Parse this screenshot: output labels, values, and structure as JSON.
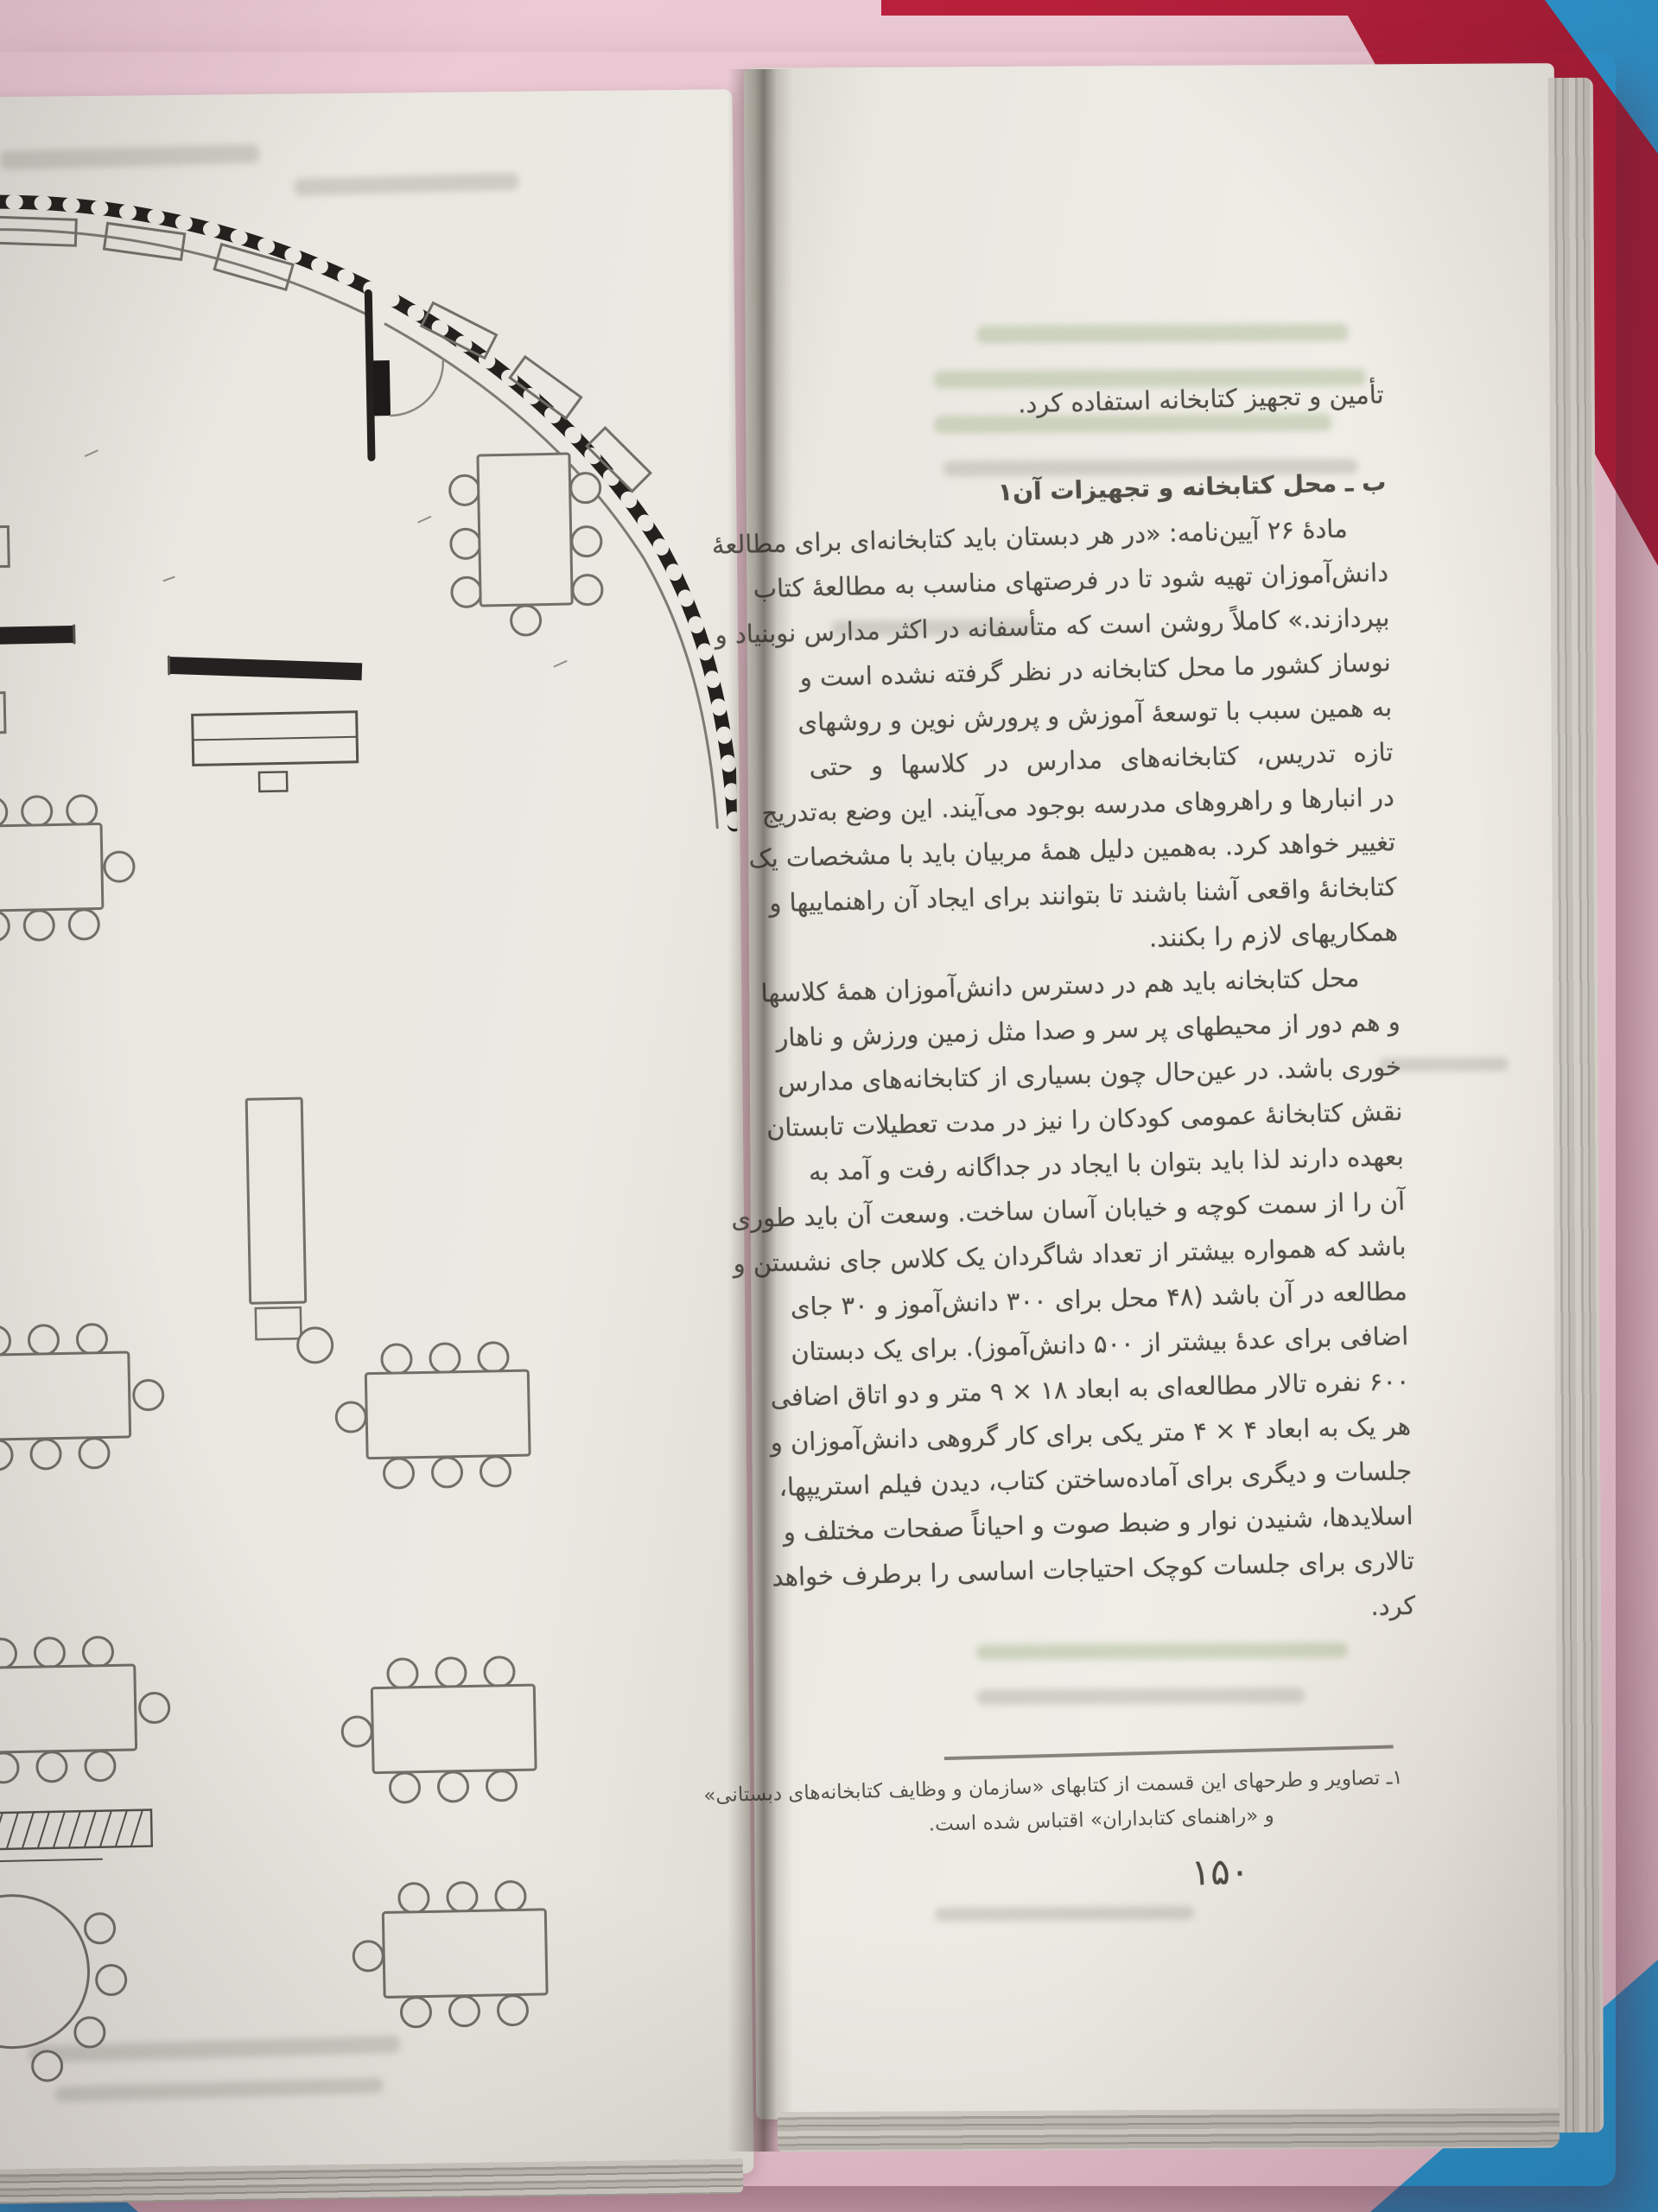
{
  "scene": {
    "background_colors": {
      "pink": "#e9c6d1",
      "red": "#b51f3a",
      "blue": "#2d9bd5"
    },
    "paper_color": "#ebe9e2"
  },
  "book": {
    "left_page": {
      "diagram": "school-library-floor-plan"
    },
    "right_page": {
      "intro_line": "تأمین و تجهیز کتابخانه استفاده کرد.",
      "section_header": "ب ـ محل کتابخانه و تجهیزات آن۱",
      "paragraph1": [
        "مادۀ ۲۶ آیین‌نامه: «در هر دبستان باید کتابخانه‌ای برای مطالعۀ",
        "دانش‌آموزان تهیه شود تا در فرصتهای مناسب به مطالعۀ کتاب",
        "بپردازند.» کاملاً روشن است که متأسفانه در اکثر مدارس نوبنیاد و",
        "نوساز کشور ما محل کتابخانه در نظر گرفته نشده است و",
        "به همین سبب با توسعۀ آموزش و پرورش نوین و روشهای",
        "تازه تدریس، کتابخانه‌های مدارس در کلاسها و حتی",
        "در انبارها و راهروهای مدرسه بوجود می‌آیند. این وضع به‌تدریج",
        "تغییر خواهد کرد. به‌همین دلیل همۀ مربیان باید با مشخصات یک",
        "کتابخانۀ واقعی آشنا باشند تا بتوانند برای ایجاد آن راهنماییها و",
        "همکاریهای لازم را بکنند."
      ],
      "paragraph2": [
        "محل کتابخانه باید هم در دسترس دانش‌آموزان همۀ کلاسها",
        "و هم دور از محیطهای پر سر و صدا مثل زمین ورزش و ناهار",
        "خوری باشد. در عین‌حال چون بسیاری از کتابخانه‌های مدارس",
        "نقش کتابخانۀ عمومی کودکان را نیز در مدت تعطیلات تابستان",
        "بعهده دارند لذا باید بتوان با ایجاد در جداگانه رفت و آمد به",
        "آن را از سمت کوچه و خیابان آسان ساخت. وسعت آن باید طوری",
        "باشد که همواره بیشتر از تعداد شاگردان یک کلاس جای نشستن و",
        "مطالعه در آن باشد (۴۸ محل برای ۳۰۰ دانش‌آموز و ۳۰ جای",
        "اضافی برای عدۀ بیشتر از ۵۰۰ دانش‌آموز). برای یک دبستان",
        "۶۰۰ نفره تالار مطالعه‌ای به ابعاد ۱۸ × ۹ متر و دو اتاق اضافی",
        "هر یک به ابعاد ۴ × ۴ متر یکی برای کار گروهی دانش‌آموزان و",
        "جلسات و دیگری برای آماده‌ساختن کتاب، دیدن فیلم استریپها،",
        "اسلایدها، شنیدن نوار و ضبط صوت و احیاناً صفحات مختلف و",
        "تالاری برای جلسات کوچک احتیاجات اساسی را برطرف خواهد",
        "کرد."
      ],
      "footnote": {
        "line1": "۱ـ تصاویر و طرحهای این قسمت از کتابهای «سازمان و وظایف کتابخانه‌های دبستانی»",
        "line2": "و «راهنمای کتابداران» اقتباس شده است."
      },
      "page_number": "۱۵۰"
    }
  }
}
